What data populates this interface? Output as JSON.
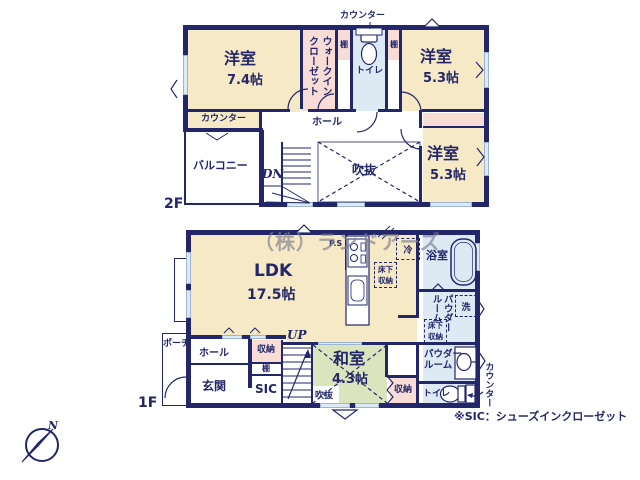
{
  "watermark": "（株）ランドアーズ",
  "note": "※SIC：シューズインクローゼット",
  "compass": {
    "north": "N"
  },
  "colors": {
    "wall": "#232769",
    "western_room": "#f6e9c5",
    "closet": "#f8dcd6",
    "wet_area": "#ddeaf4",
    "tatami": "#dbe5bd",
    "window": "#dceaf5"
  },
  "f2": {
    "floor": "2F",
    "counter_top": "カウンター",
    "room1": "洋室",
    "room1_size": "7.4帖",
    "wic": "ウォークインクローゼット",
    "shelf": "棚",
    "toilet": "トイレ",
    "room2": "洋室",
    "room2_size": "5.3帖",
    "room3": "洋室",
    "room3_size": "5.3帖",
    "counter_desk": "カウンター",
    "balcony": "バルコニー",
    "hall": "ホール",
    "dn": "DN",
    "void": "吹抜"
  },
  "f1": {
    "floor": "1F",
    "ps": "P.S",
    "ldk": "LDK",
    "ldk_size": "17.5帖",
    "fridge": "冷",
    "bath": "浴室",
    "underfloor": "床下収納",
    "washer": "洗",
    "powder": "パウダールーム",
    "toilet": "トイレ",
    "counter_side": "カウンター",
    "up": "UP",
    "washitsu": "和室",
    "washitsu_size": "4.3帖",
    "void": "吹抜",
    "closet": "収納",
    "shelf": "棚",
    "genkan": "玄関",
    "hall": "ホール",
    "sic": "SIC",
    "porch": "ポーチ"
  }
}
